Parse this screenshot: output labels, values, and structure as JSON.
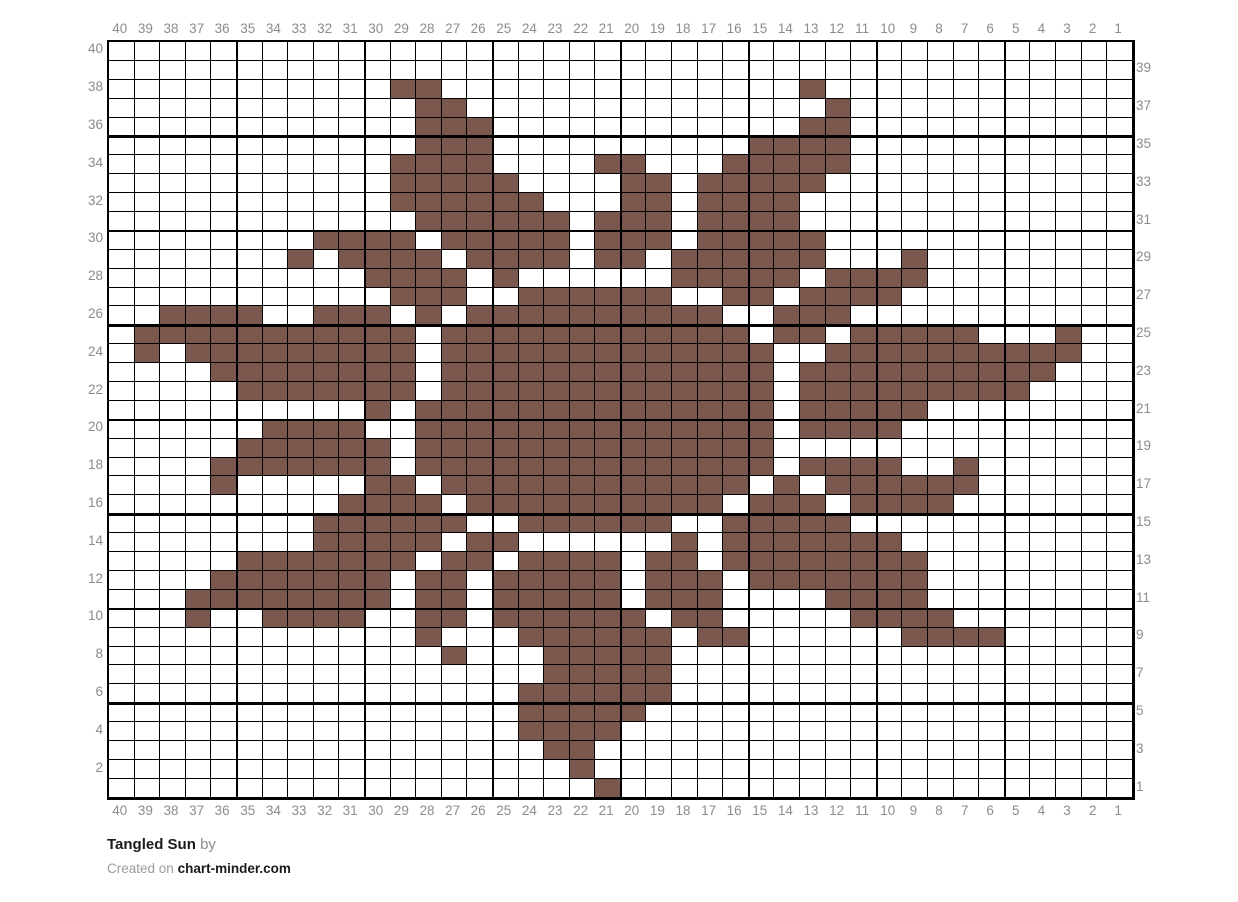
{
  "chart_data": {
    "type": "heatmap",
    "title": "Tangled Sun",
    "grid": {
      "columns": 40,
      "rows": 40
    },
    "legend": "filled cells use stitch color, empty cells are background",
    "fill_color": "#7b584e",
    "empty_color": "#ffffff",
    "grid_line_color": "#000000",
    "bold_line_every": 5,
    "axis": {
      "top": [
        40,
        39,
        38,
        37,
        36,
        35,
        34,
        33,
        32,
        31,
        30,
        29,
        28,
        27,
        26,
        25,
        24,
        23,
        22,
        21,
        20,
        19,
        18,
        17,
        16,
        15,
        14,
        13,
        12,
        11,
        10,
        9,
        8,
        7,
        6,
        5,
        4,
        3,
        2,
        1
      ],
      "bottom": [
        40,
        39,
        38,
        37,
        36,
        35,
        34,
        33,
        32,
        31,
        30,
        29,
        28,
        27,
        26,
        25,
        24,
        23,
        22,
        21,
        20,
        19,
        18,
        17,
        16,
        15,
        14,
        13,
        12,
        11,
        10,
        9,
        8,
        7,
        6,
        5,
        4,
        3,
        2,
        1
      ],
      "left": [
        40,
        38,
        36,
        34,
        32,
        30,
        28,
        26,
        24,
        22,
        20,
        18,
        16,
        14,
        12,
        10,
        8,
        6,
        4,
        2
      ],
      "right": [
        39,
        37,
        35,
        33,
        31,
        29,
        27,
        25,
        23,
        21,
        19,
        17,
        15,
        13,
        11,
        9,
        7,
        5,
        3,
        1
      ]
    },
    "pattern_rows_top_to_bottom": [
      "........................................",
      "........................................",
      "...........XX..............X............",
      "............XX..............X...........",
      "............XXX............XX...........",
      "............XXX..........XXXX...........",
      "...........XXXX....XX...XXXXX...........",
      "...........XXXXX....XX.XXXXX............",
      "...........XXXXXX...XX.XXXX.............",
      "............XXXXXX.XXX.XXXX.............",
      "........XXXX.XXXXX.XXX.XXXXX............",
      ".......X.XXXX.XXXX.XX.XXXXXX...X........",
      "..........XXXX.X......XXXXX.XXXX........",
      "...........XXX..XXXXXX..XX.XXXX.........",
      "..XXXX..XXX.X.XXXXXXXXXX..XXX...........",
      ".XXXXXXXXXXX.XXXXXXXXXXXX.XX.XXXXX...X..",
      ".X.XXXXXXXXX.XXXXXXXXXXXXX..XXXXXXXXXX..",
      "....XXXXXXXX.XXXXXXXXXXXXX.XXXXXXXXXX...",
      ".....XXXXXXX.XXXXXXXXXXXXX.XXXXXXXXX....",
      "..........X.XXXXXXXXXXXXXX.XXXXX........",
      "......XXXX..XXXXXXXXXXXXXX.XXXX.........",
      ".....XXXXXX.XXXXXXXXXXXXXX..............",
      "....XXXXXXX.XXXXXXXXXXXXXX.XXXX..X......",
      "....X.....XX.XXXXXXXXXXXX.X.XXXXXX......",
      ".........XXXX.XXXXXXXXXX.XXX.XXXX.......",
      "........XXXXXX..XXXXXX..XXXXX...........",
      "........XXXXX.XX......X.XXXXXXX.........",
      ".....XXXXXXX.XX.XXXX.XX.XXXXXXXX........",
      "....XXXXXXX.XX.XXXXX.XXX.XXXXXXX........",
      "...XXXXXXXX.XX.XXXXX.XXX....XXXX........",
      "...X..XXXX..XX.XXXXXX.XX.....XXXX.......",
      "............X...XXXXXX.XX......XXXX.....",
      ".............X...XXXXX..................",
      ".................XXXXX..................",
      "................XXXXXX..................",
      "................XXXXX...................",
      "................XXXX....................",
      ".................XX.....................",
      "..................X.....................",
      "...................X...................."
    ]
  },
  "footer": {
    "title": "Tangled Sun",
    "by_label": "by",
    "created_prefix": "Created on",
    "site": "chart-minder.com"
  },
  "colors": {
    "stitch_brown": "#7b584e",
    "grid_line": "#000000",
    "axis_label_gray": "#8c8c8c",
    "text_dark": "#1a1a1a"
  }
}
